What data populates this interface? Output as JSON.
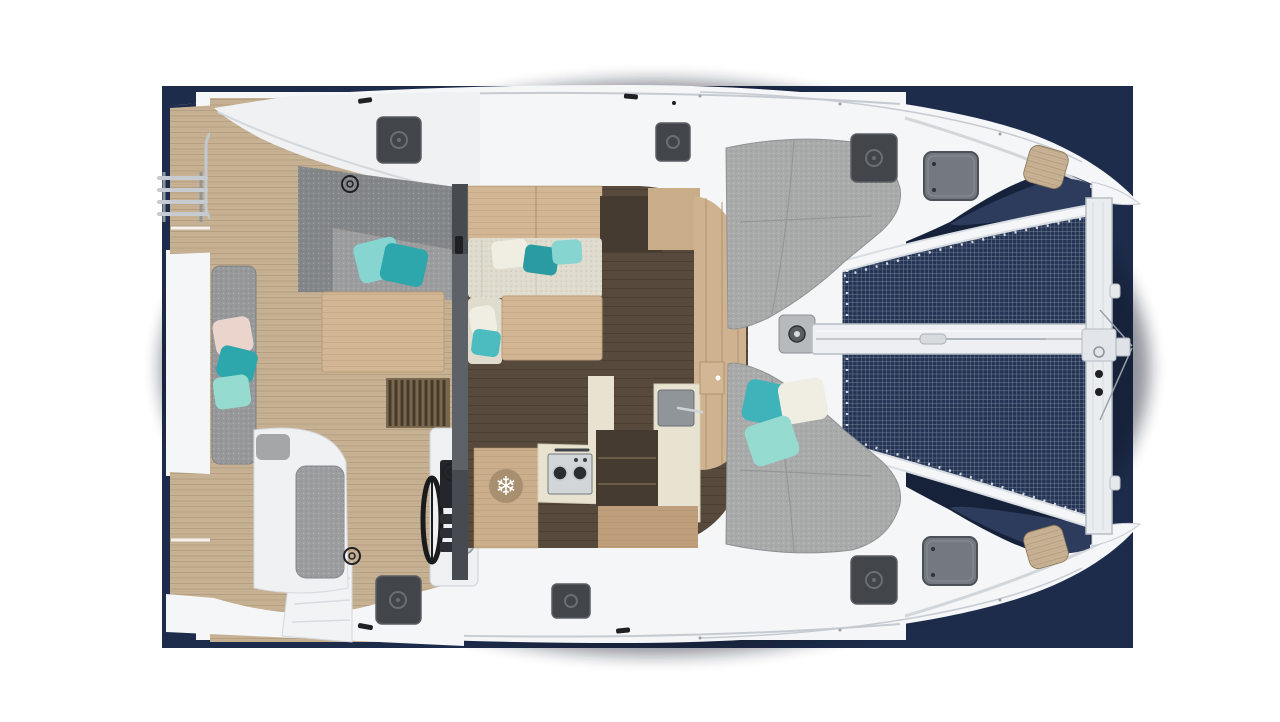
{
  "meta": {
    "description": "Top-down render of a catamaran deck layout on a navy backdrop: aft swim platforms and teak cockpit (left), saloon with galley amidships, gray foredeck sunpads, and bow trampoline with forward crossbeam (right)."
  },
  "colors": {
    "page": "#ffffff",
    "navy": "#1e2c4b",
    "navy_gap": "#2d3c5c",
    "tramp": "#243454",
    "mesh_line": "#c9d1de",
    "hull": "#f4f6f8",
    "hull_line": "#c6cbd1",
    "roof": "#eff1f3",
    "teak": "#c8b295",
    "teak_line": "#a28a6a",
    "gray_cushion": "#9b9d9f",
    "gray_dark": "#84878a",
    "sunpad": "#a8abaa",
    "bench": "#96989a",
    "teal": "#2da6ac",
    "teal_light": "#86d5d1",
    "mint": "#95dbd0",
    "pink": "#ead4cc",
    "pillow_white": "#f0eee3",
    "cream": "#e8e3d1",
    "sofa": "#dfdbcd",
    "wood": "#d3b794",
    "wood_dark": "#8a7353",
    "floor": "#574a3d",
    "interior_dark": "#463b30",
    "hatch": "#42464b",
    "hatch_ring": "#6a6f74",
    "window": "#74797f",
    "frame_dark": "#4c5157",
    "steel": "#b9bfc6",
    "beam": "#edeff2",
    "beam_line": "#b6bcc4",
    "black": "#1e2023",
    "snow_bg": "#a78f70",
    "divider": "#5d6268"
  },
  "icons": {
    "snowflake": "❄"
  }
}
